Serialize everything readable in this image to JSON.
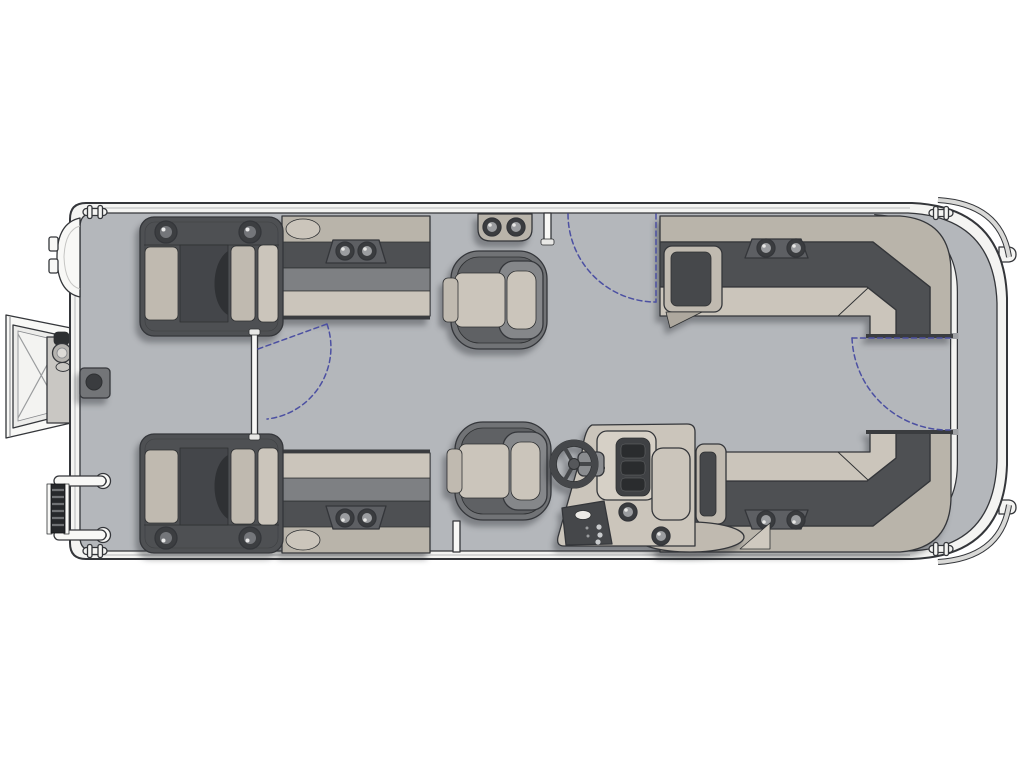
{
  "figure": {
    "title": "Pontoon boat floor plan - top view",
    "type": "floorplan-diagram",
    "orientation": {
      "bow": "right",
      "stern": "left",
      "port": "top",
      "starboard": "bottom"
    },
    "background": "#ffffff"
  },
  "palette": {
    "outline": "#34363a",
    "rim": "#f4f4f2",
    "rimShade": "#d9d9d7",
    "deck": "#b4b7bb",
    "deckTan": "#b9b4aa",
    "dark1": "#4e5053",
    "dark2": "#3a3c3f",
    "mid": "#7e8083",
    "mid2": "#85878a",
    "beige1": "#cbc5bb",
    "beige2": "#c0bab0",
    "white": "#f8f8f6",
    "blue": "#4c50a2",
    "shadow": "rgba(40,42,48,0.38)"
  },
  "components": {
    "figureRoot": {
      "label": "Pontoon boat floor plan, top view"
    },
    "hull": {
      "label": "Pontoon hull with rub rail"
    },
    "deck": {
      "label": "Main deck"
    },
    "fence": {
      "label": "Bow fence rail with gate posts"
    },
    "bowDeck": {
      "label": "Bow boarding deck"
    },
    "cleat": {
      "label": "Mooring cleat",
      "count": 4
    },
    "noseTab": {
      "label": "Pontoon nose cone tab",
      "count": 2
    },
    "motorPod": {
      "label": "Stern pod"
    },
    "sternRamp": {
      "label": "Fold-out stern boarding gate ramp with cross bracing"
    },
    "rampLatch": {
      "label": "Ramp latch knob and hinge cup"
    },
    "ladder": {
      "label": "Reboarding ladder"
    },
    "grabHandle": {
      "label": "Grab handle with eye ring",
      "count": 2
    },
    "tableBase": {
      "label": "Table pedestal base"
    },
    "portLounger": {
      "label": "Port stern chaise lounger with speaker knobs"
    },
    "stbdLounger": {
      "label": "Starboard stern chaise lounger with speaker knobs"
    },
    "portBench": {
      "label": "Port bench seat with twin cup holders"
    },
    "stbdBench": {
      "label": "Starboard bench seat with twin cup holders"
    },
    "portCouch": {
      "label": "Port bow L-shaped couch with armrest and cup holders"
    },
    "stbdCouch": {
      "label": "Starboard bow L-shaped couch with armrest and cup holders"
    },
    "wallCupPod": {
      "label": "Rail-mounted twin cup holder"
    },
    "portChair": {
      "label": "Port swivel captain chair"
    },
    "helmChair": {
      "label": "Helm swivel captain chair"
    },
    "console": {
      "label": "Helm console"
    },
    "dashboard": {
      "label": "Helm dashboard gauge cluster"
    },
    "switchPanel": {
      "label": "Helm switch panel"
    },
    "wheel": {
      "label": "Steering wheel"
    },
    "portGate": {
      "label": "Port side gate swing path"
    },
    "bowGate": {
      "label": "Bow gate swing path"
    },
    "sternGate": {
      "label": "Stern gate swing path"
    }
  },
  "details": {
    "cupHoldersPerPod": 2,
    "swivelChairs": 2,
    "chaiseLoungers": 2,
    "benchSeats": 2,
    "lShapedCouches": 2,
    "gatesWithSwingArcs": 3,
    "cleats": 4
  }
}
